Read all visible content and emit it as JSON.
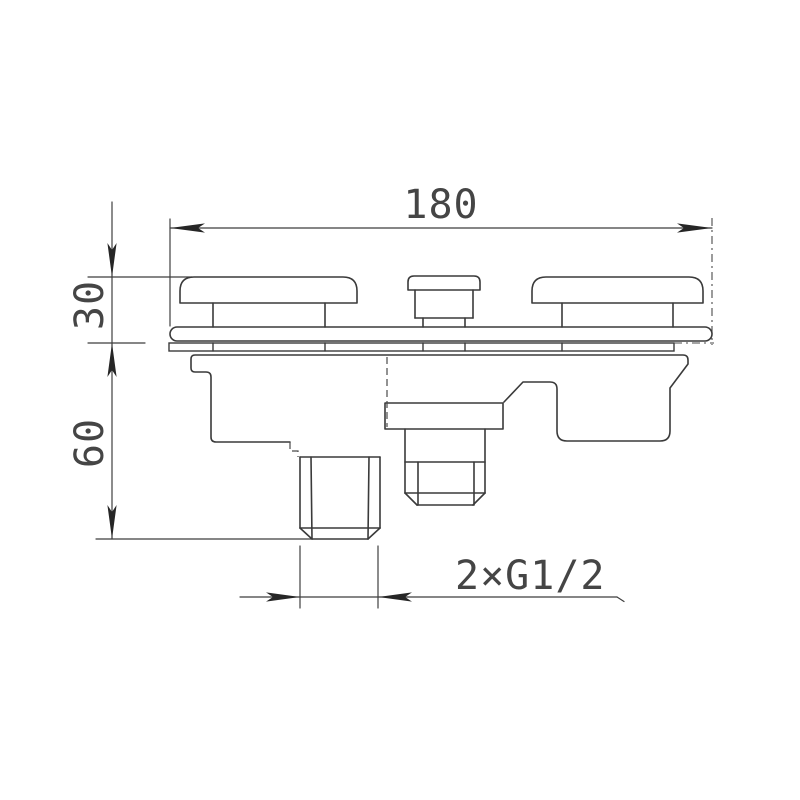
{
  "drawing": {
    "type": "technical-dimension-drawing",
    "subject": "wall-mounted mixer valve, front elevation",
    "background_color": "#ffffff",
    "line_color": "#3a3a3a",
    "text_color": "#454545",
    "dimensions": {
      "overall_width": {
        "label": "180"
      },
      "upper_height": {
        "label": "30"
      },
      "lower_height": {
        "label": "60"
      },
      "thread_callout": {
        "label": "2×G1/2"
      }
    }
  }
}
